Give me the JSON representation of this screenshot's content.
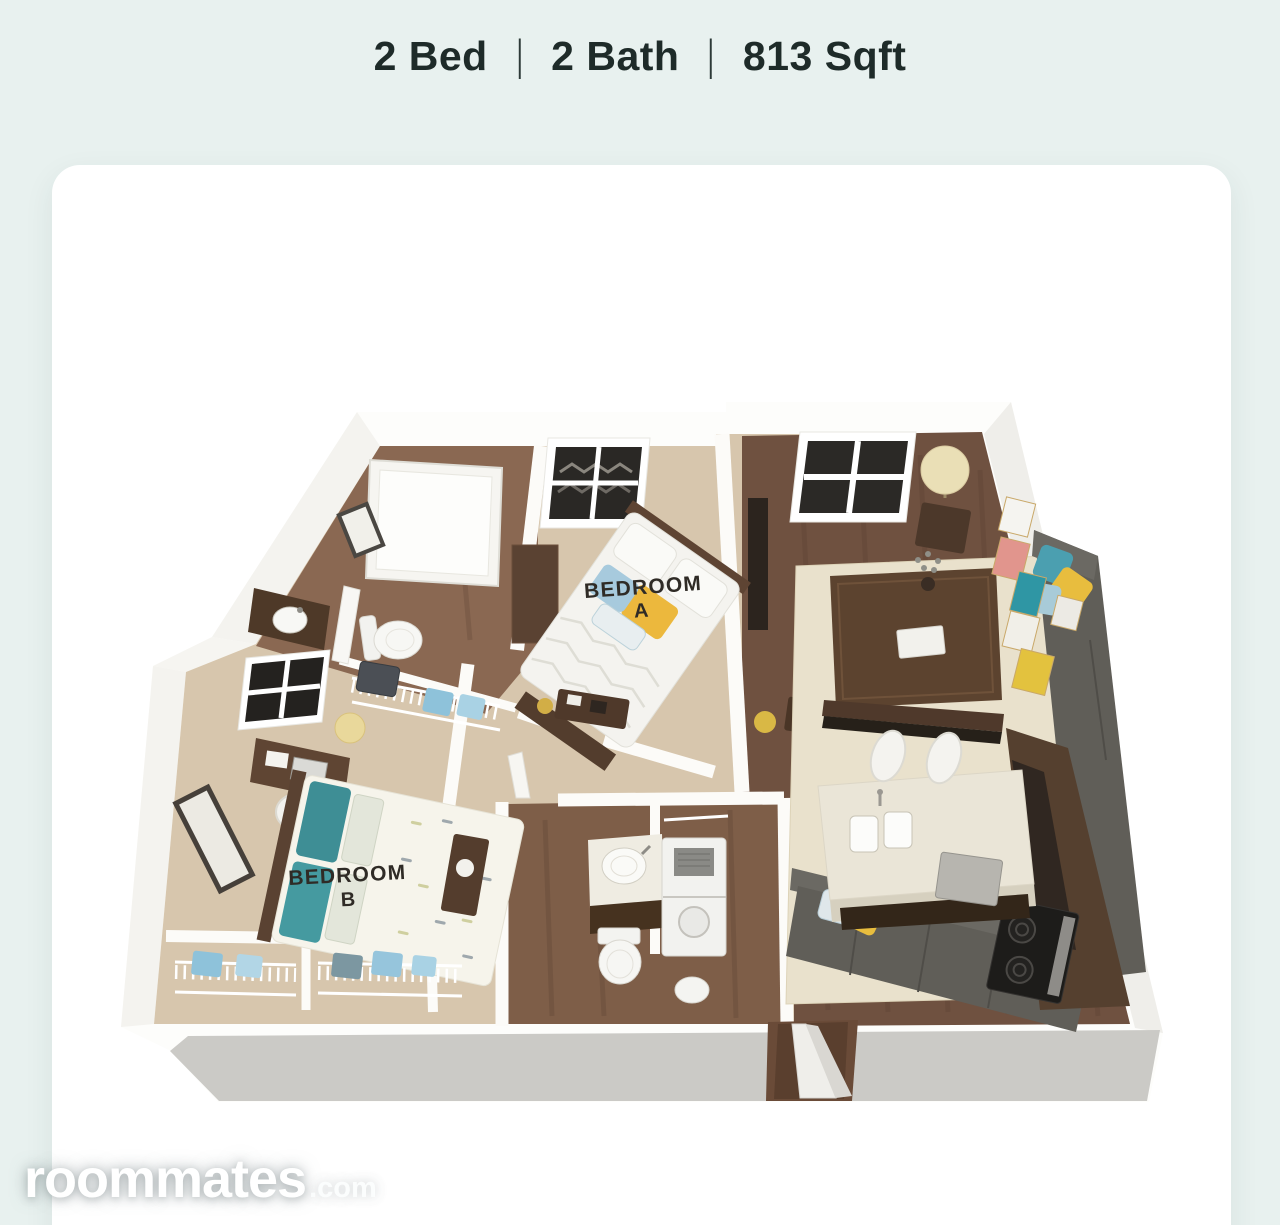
{
  "header": {
    "items": [
      {
        "label": "2 Bed"
      },
      {
        "label": "2 Bath"
      },
      {
        "label": "813 Sqft"
      }
    ],
    "separator": "|"
  },
  "floorplan": {
    "bedroom_a": {
      "line1": "BEDROOM",
      "line2": "A"
    },
    "bedroom_b": {
      "line1": "BEDROOM",
      "line2": "B"
    }
  },
  "watermark": {
    "brand": "roommates",
    "suffix": ".com"
  },
  "colors": {
    "page_background": "#e8f1ef",
    "card_background": "#ffffff",
    "header_text": "#1e2b29",
    "watermark_text": "#ffffff",
    "wall_white": "#fcfbf8",
    "wall_front_face": "#cbcac6",
    "carpet": "#d7c6ad",
    "wood_floor": "#6f5140",
    "bath_wood_floor": "#8a6852",
    "sofa_gray": "#605e58",
    "rug_cream": "#e9e1cc",
    "cabinet_brown": "#55402f",
    "accent_yellow": "#e8bd3e",
    "accent_teal": "#3f9fae",
    "accent_pink": "#e1958d",
    "accent_blue": "#8ec2da",
    "label_text": "#2f2b26"
  }
}
